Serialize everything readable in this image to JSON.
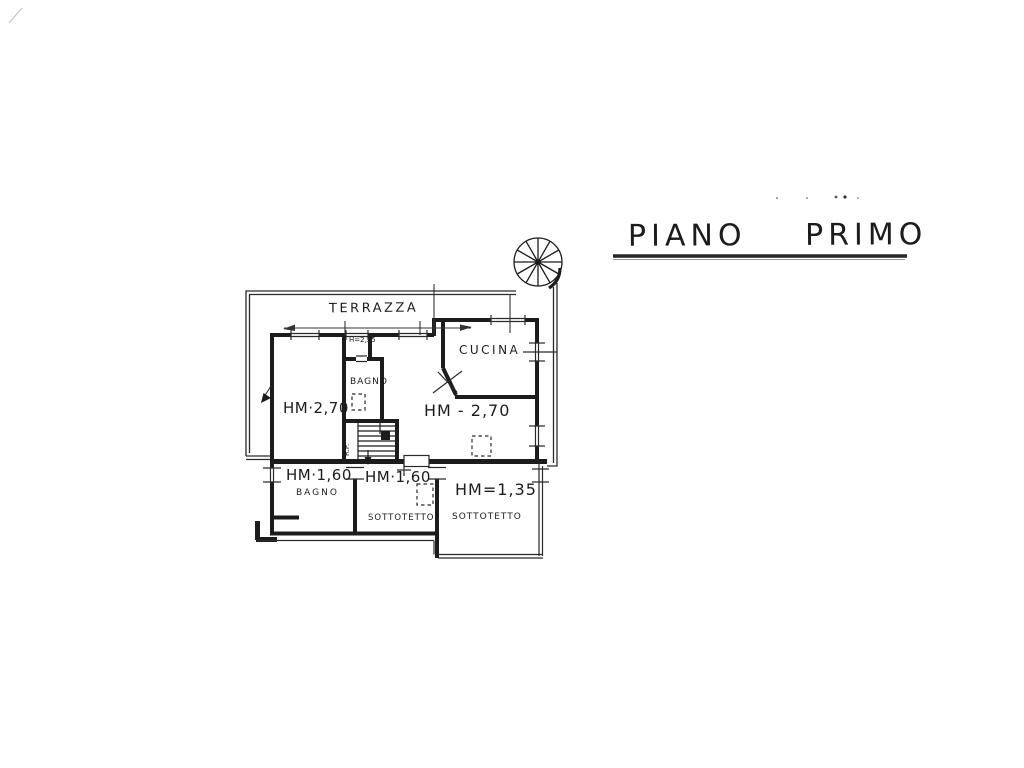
{
  "title": "PIANO PRIMO",
  "colors": {
    "ink": "#1c1c1c",
    "paper": "#ffffff"
  },
  "plan": {
    "region_labels": {
      "terrazza": "TERRAZZA",
      "cucina": "CUCINA",
      "bagno_upper": "BAGNO",
      "bagno_lower": "BAGNO",
      "sottotetto_middle": "SOTTOTETTO",
      "sottotetto_right": "SOTTOTETTO"
    },
    "height_labels": {
      "room_left": "HM·2,70",
      "room_main": "HM - 2,70",
      "passage": "H=2,25",
      "bagno_lower": "HM·1,60",
      "sottotetto_middle": "HM·1,60",
      "sottotetto_right": "HM=1,35"
    },
    "stair_note": "R.P."
  }
}
